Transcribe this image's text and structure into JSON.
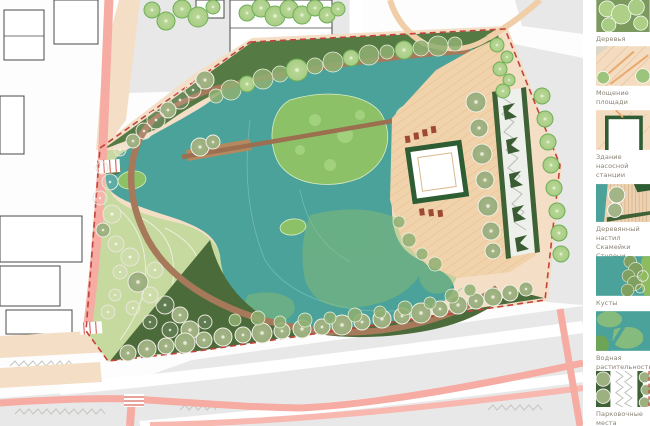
{
  "meta": {
    "drawing_type": "landscape masterplan with pond park",
    "language": "ru"
  },
  "palette": {
    "water": "#4aa29a",
    "island_green": "#8cc168",
    "lawn_dark": "#567a44",
    "slope_dark": "#4c6b3b",
    "terrace_light": "#c6d99f",
    "boardwalk_brown": "#a5795a",
    "plaza_peach": "#f1d3ab",
    "sidewalk_peach": "#f4dfc6",
    "road_pink": "#f6aca2",
    "boundary_red_dashed": "#c2433c",
    "pump_station_frame": "#2e5c33",
    "city_block_gray": "#e8e8e8",
    "parking_green": "#3f6136",
    "legend_text": "#8b8274"
  },
  "legend": {
    "items": [
      {
        "id": "trees",
        "label_lines": [
          "Деревья"
        ]
      },
      {
        "id": "paving",
        "label_lines": [
          "Мощение площади"
        ]
      },
      {
        "id": "pump-station",
        "label_lines": [
          "Здание насосной",
          "станции"
        ]
      },
      {
        "id": "wood-deck",
        "label_lines": [
          "Деревянный настил",
          "Скамейки Ступени"
        ]
      },
      {
        "id": "bushes",
        "label_lines": [
          "Кусты"
        ]
      },
      {
        "id": "aquatic",
        "label_lines": [
          "Водная растительность"
        ]
      },
      {
        "id": "parking",
        "label_lines": [
          "Парковочные места"
        ]
      }
    ]
  }
}
